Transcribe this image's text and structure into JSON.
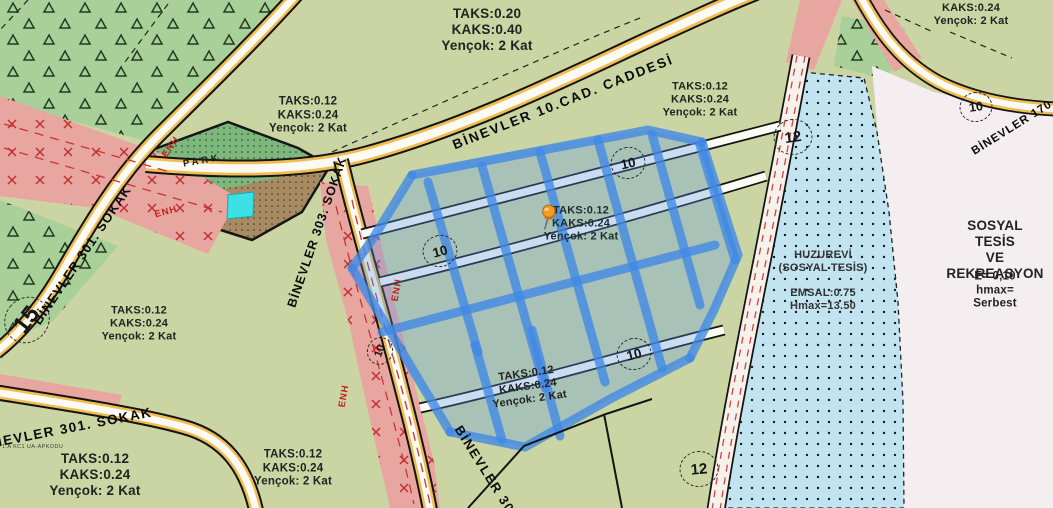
{
  "zones": {
    "z1": {
      "text": "TAKS:0.20\nKAKS:0.40\nYençok: 2 Kat"
    },
    "z2": {
      "text": "TAKS:0.12\nKAKS:0.24\nYençok: 2 Kat"
    },
    "z3": {
      "text": "TAKS:0.12\nKAKS:0.24\nYençok: 2 Kat"
    },
    "z4": {
      "text": "KAKS:0.24\nYençok: 2 Kat"
    },
    "z5": {
      "text": "TAKS:0.12\nKAKS:0.24\nYençok: 2 Kat"
    },
    "z6": {
      "text": "TAKS:0.12\nKAKS:0.24\nYençok: 2 Kat"
    },
    "z7": {
      "text": "TAKS:0.12\nKAKS:0.24\nYençok: 2 Kat"
    },
    "z8": {
      "text": "TAKS:0.12\nKAKS:0.24\nYençok: 2 Kat"
    },
    "z9": {
      "text": "TAKS:0.12\nKAKS:0.24\nYençok: 2 Kat"
    }
  },
  "facilities": {
    "huzurevi": {
      "name": "HUZUREVİ\n(SOSYAL TESİS)",
      "values": "EMSAL:0.75\nHmax=13.50"
    },
    "sosyal_tesis": {
      "title": "SOSYAL TESİS\nVE\nREKREASYON",
      "values": "E= 0,10\nhmax= Serbest"
    }
  },
  "roads": {
    "cad10": {
      "label": "BİNEVLER 10.CAD. CADDESİ"
    },
    "sokak301_upper": {
      "label": "BİNEVLER 301. SOKAK"
    },
    "sokak301_lower": {
      "label": "BİNEVLER 301. SOKAK"
    },
    "sokak303_upper": {
      "label": "BİNEVLER 303. SOKAK"
    },
    "sokak303_lower": {
      "label": "BİNEVLER 303"
    },
    "sokak17": {
      "label": "BİNEVLER 170"
    }
  },
  "markers": {
    "w15": {
      "value": "15"
    },
    "w10a": {
      "value": "10"
    },
    "w10b": {
      "value": "10"
    },
    "w10c": {
      "value": "10"
    },
    "w12a": {
      "value": "12"
    },
    "w12b": {
      "value": "12"
    },
    "w10d": {
      "value": "10"
    },
    "w10e": {
      "value": "10"
    }
  },
  "annotations": {
    "park": "PARK",
    "enh": "ENH",
    "small_note": "1.A KC1 UA-APKODU"
  },
  "colors": {
    "base_green": "#cbd5a3",
    "forest_green": "#a9d098",
    "park_green": "#7db77d",
    "park_brown": "#a98a62",
    "enh_pink": "#e8a6a1",
    "huzurevi_blue": "#c2e4f1",
    "recreation_pale": "#f4eef0",
    "road_yellow": "#f0bd55",
    "road_white": "#fbfaf3",
    "selection_blue": "#3f88e6",
    "enh_red": "#cc3333",
    "pin_orange": "#f59a23",
    "marker_cyan": "#3be1e4"
  }
}
